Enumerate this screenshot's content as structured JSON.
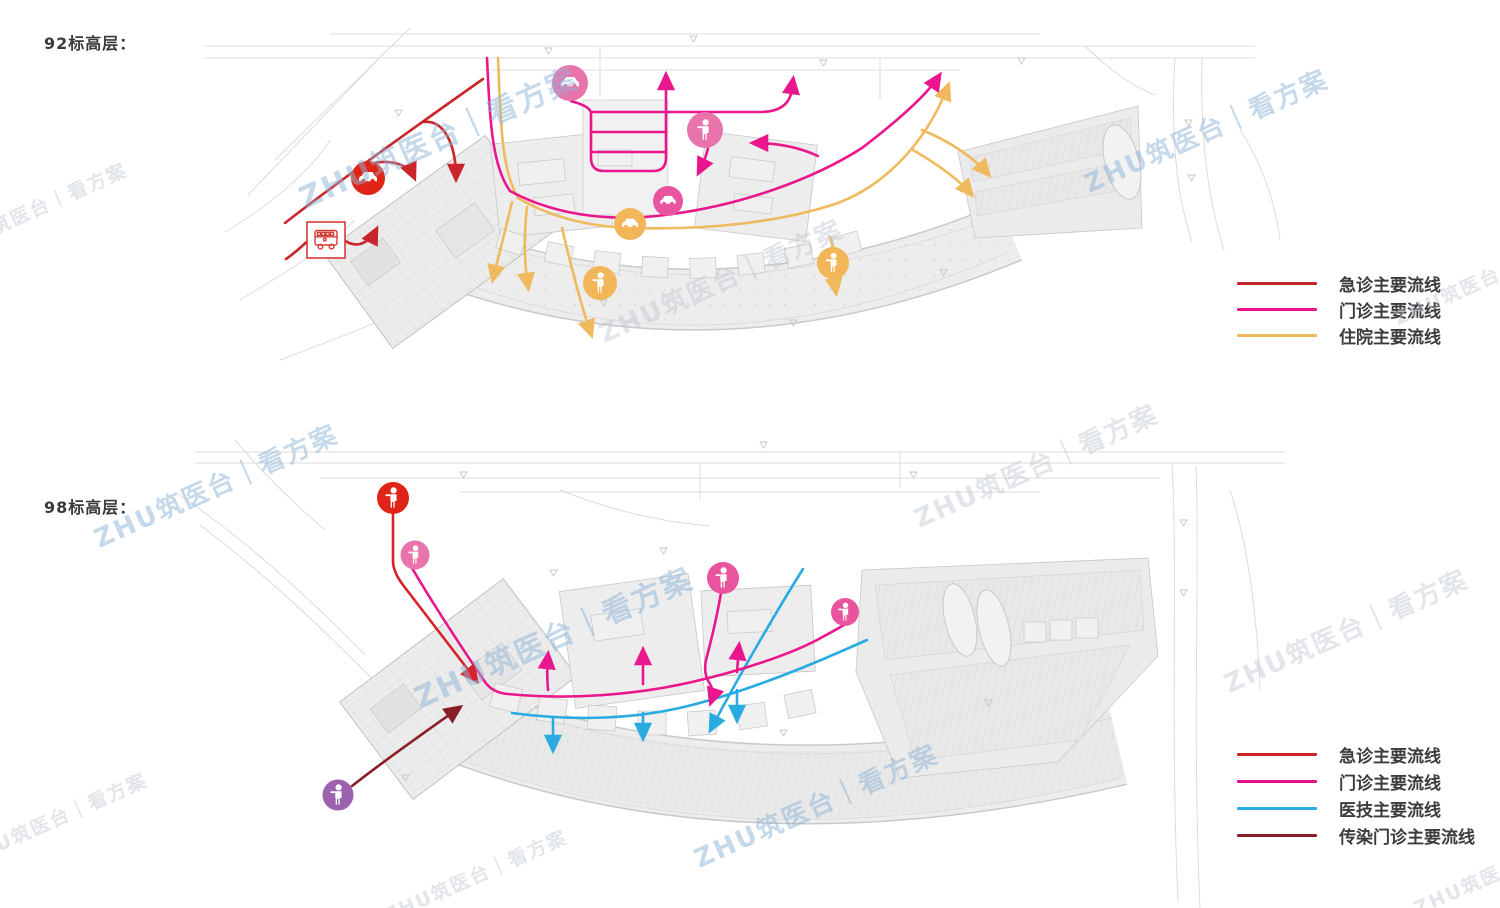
{
  "page_type": "hospital circulation flow diagram, two site-plan levels with legends",
  "floor_labels": {
    "top": "92标高层：",
    "bottom": "98标高层："
  },
  "watermark": {
    "text": "ZHU筑医台｜看方案"
  },
  "colors": {
    "emergency_red": "#c9252b",
    "outpatient_magenta": "#ea168d",
    "inpatient_orange": "#efba5e",
    "medtech_blue": "#29abe2",
    "infectious_maroon": "#8a1e26",
    "emergency_red_bottom": "#d6232a",
    "icon_red": "#e02417",
    "icon_pink_light": "#e973ab",
    "icon_pink": "#e8559e",
    "icon_orange": "#f2b558",
    "icon_purple": "#9c62ad",
    "bus_red_outline": "#d43c38",
    "plan_gray": "#dcdcdc"
  },
  "legend_top": {
    "items": [
      {
        "label": "急诊主要流线",
        "color": "#c1272d"
      },
      {
        "label": "门诊主要流线",
        "color": "#ec0f8e"
      },
      {
        "label": "住院主要流线",
        "color": "#efba5e"
      }
    ]
  },
  "legend_bottom": {
    "items": [
      {
        "label": "急诊主要流线",
        "color": "#cc2229"
      },
      {
        "label": "门诊主要流线",
        "color": "#e5118c"
      },
      {
        "label": "医技主要流线",
        "color": "#29abe2"
      },
      {
        "label": "传染门诊主要流线",
        "color": "#8a1e26"
      }
    ]
  },
  "maps": {
    "top": {
      "name": "92标高层流线图",
      "icons": [
        "car-icon-red",
        "bus-icon-red-outline",
        "car-icon-pink",
        "pedestrian-icon-pink",
        "car-icon-magenta",
        "car-icon-orange",
        "pedestrian-icon-orange-left",
        "pedestrian-icon-orange-right"
      ],
      "flows": [
        "急诊主要流线",
        "门诊主要流线",
        "住院主要流线"
      ]
    },
    "bottom": {
      "name": "98标高层流线图",
      "icons": [
        "pedestrian-icon-red",
        "pedestrian-icon-pink-upper",
        "pedestrian-icon-pink-center",
        "pedestrian-icon-pink-right",
        "pedestrian-icon-purple"
      ],
      "flows": [
        "急诊主要流线",
        "门诊主要流线",
        "医技主要流线",
        "传染门诊主要流线"
      ]
    }
  }
}
